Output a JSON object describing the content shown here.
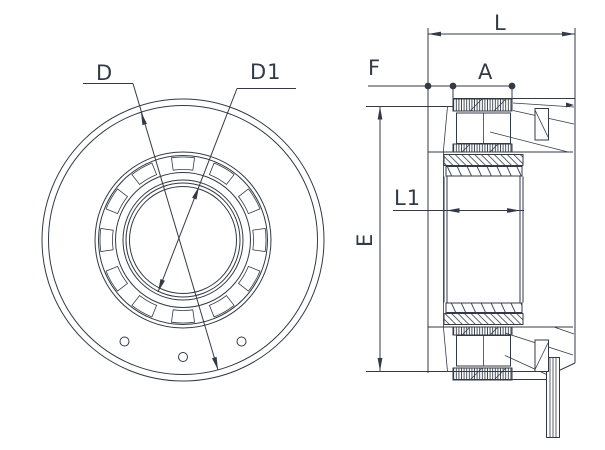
{
  "drawing": {
    "labels": {
      "d": "D",
      "d1": "D1",
      "l": "L",
      "f": "F",
      "a": "A",
      "e": "E",
      "l1": "L1"
    },
    "colors": {
      "line": "#333a46",
      "background": "#ffffff"
    }
  }
}
